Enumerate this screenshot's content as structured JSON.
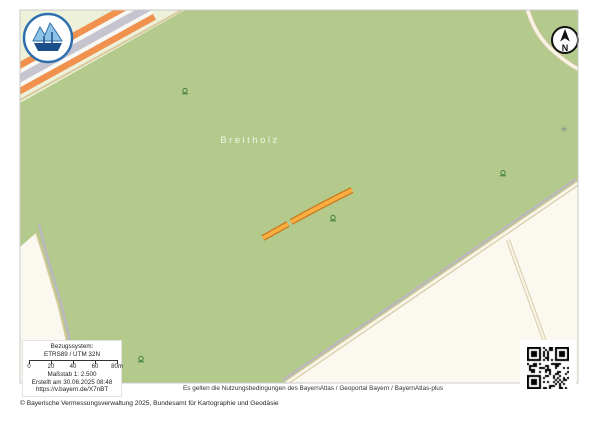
{
  "map": {
    "place_label": "Breitholz",
    "north_label": "N"
  },
  "info_box": {
    "ref_system_label": "Bezugssystem:",
    "ref_system_value": "ETRS89 / UTM 32N",
    "scale_ticks": [
      "0",
      "20",
      "40",
      "60",
      "80m"
    ],
    "scale_label": "Maßstab 1: 2.500",
    "created_label": "Erstellt am 30.06.2025 08:48",
    "url": "https://v.bayern.de/X7nBT"
  },
  "footer": {
    "terms": "Es gelten die Nutzungsbedingungen des BayernAtlas / Geoportal Bayern / BayernAtlas-plus",
    "copyright": "© Bayerische Vermessungsverwaltung 2025, Bundesamt für Kartographie und Geodäsie"
  },
  "colors": {
    "forest": "#b4ca8d",
    "pale": "#edf1da",
    "field": "#fbf9ef",
    "edge_tan": "#d8c89c",
    "road_gray": "#bcb6c0",
    "road_casing": "#cfc49a",
    "road_inner": "#f7f4e6",
    "motorway_orange": "#f0914e",
    "motorway_gray": "#c6c4cf",
    "route_fill": "#f9ae43",
    "route_border": "#c9791a",
    "tree": "#3f7d3f",
    "marker_gray": "#8f8f8f",
    "badge_blue": "#2f6fad",
    "badge_light": "#8ec3e8",
    "badge_dark": "#1d4f8c"
  },
  "features": {
    "trees": [
      [
        185,
        93
      ],
      [
        333,
        220
      ],
      [
        503,
        175
      ],
      [
        141,
        361
      ]
    ],
    "route_segments": [
      "M263,238 L288,224",
      "M291,222 Q320,206 352,190"
    ],
    "gray_marker": [
      564,
      129
    ]
  }
}
